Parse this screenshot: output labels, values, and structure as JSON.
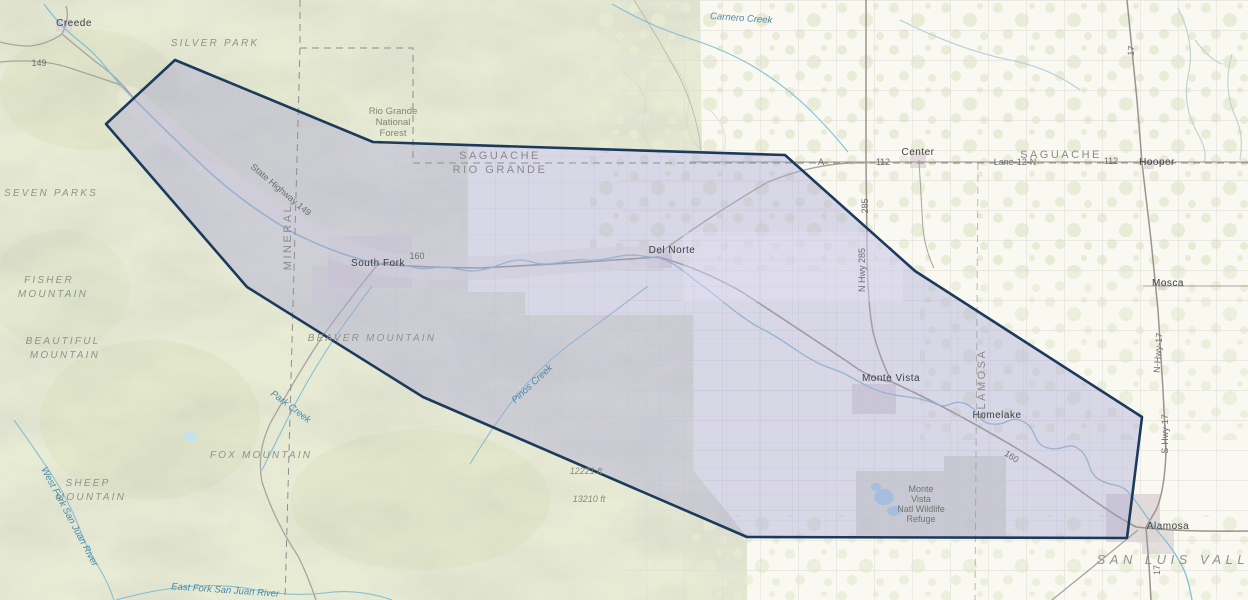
{
  "map": {
    "labels": [
      {
        "text": "Creede",
        "x": 74,
        "y": 26,
        "rot": 0,
        "cls": "town"
      },
      {
        "text": "South Fork",
        "x": 378,
        "y": 266,
        "rot": 0,
        "cls": "town"
      },
      {
        "text": "Del Norte",
        "x": 672,
        "y": 253,
        "rot": 0,
        "cls": "town"
      },
      {
        "text": "Monte Vista",
        "x": 891,
        "y": 381,
        "rot": 0,
        "cls": "town"
      },
      {
        "text": "Center",
        "x": 918,
        "y": 155,
        "rot": 0,
        "cls": "town"
      },
      {
        "text": "Hooper",
        "x": 1157,
        "y": 165,
        "rot": 0,
        "cls": "town"
      },
      {
        "text": "Mosca",
        "x": 1168,
        "y": 286,
        "rot": 0,
        "cls": "town"
      },
      {
        "text": "Homelake",
        "x": 997,
        "y": 418,
        "rot": 0,
        "cls": "town"
      },
      {
        "text": "Alamosa",
        "x": 1168,
        "y": 529,
        "rot": 0,
        "cls": "town"
      },
      {
        "text": "SAGUACHE",
        "x": 500,
        "y": 159,
        "rot": 0,
        "cls": "county"
      },
      {
        "text": "RIO GRANDE",
        "x": 500,
        "y": 173,
        "rot": 0,
        "cls": "county"
      },
      {
        "text": "SAGUACHE",
        "x": 1061,
        "y": 158,
        "rot": 0,
        "cls": "county"
      },
      {
        "text": "MINERAL",
        "x": 291,
        "y": 237,
        "rot": -90,
        "cls": "county"
      },
      {
        "text": "ALAMOSA",
        "x": 985,
        "y": 384,
        "rot": -90,
        "cls": "county"
      },
      {
        "text": "SILVER PARK",
        "x": 215,
        "y": 46,
        "rot": 0,
        "cls": "park"
      },
      {
        "text": "SEVEN PARKS",
        "x": 51,
        "y": 196,
        "rot": 0,
        "cls": "park"
      },
      {
        "text": "FISHER",
        "x": 49,
        "y": 283,
        "rot": 0,
        "cls": "park"
      },
      {
        "text": "MOUNTAIN",
        "x": 53,
        "y": 297,
        "rot": 0,
        "cls": "park"
      },
      {
        "text": "BEAUTIFUL",
        "x": 63,
        "y": 344,
        "rot": 0,
        "cls": "park"
      },
      {
        "text": "MOUNTAIN",
        "x": 65,
        "y": 358,
        "rot": 0,
        "cls": "park"
      },
      {
        "text": "SHEEP",
        "x": 88,
        "y": 486,
        "rot": 0,
        "cls": "park"
      },
      {
        "text": "MOUNTAIN",
        "x": 91,
        "y": 500,
        "rot": 0,
        "cls": "park"
      },
      {
        "text": "FOX MOUNTAIN",
        "x": 261,
        "y": 458,
        "rot": 0,
        "cls": "park"
      },
      {
        "text": "BEAVER MOUNTAIN",
        "x": 372,
        "y": 341,
        "rot": 0,
        "cls": "park"
      },
      {
        "text": "SAN LUIS VALLEY",
        "x": 1186,
        "y": 564,
        "rot": 0,
        "cls": "park-lg"
      },
      {
        "text": "Rio Grande",
        "x": 393,
        "y": 114,
        "rot": 0,
        "cls": "forest"
      },
      {
        "text": "National",
        "x": 393,
        "y": 125,
        "rot": 0,
        "cls": "forest"
      },
      {
        "text": "Forest",
        "x": 393,
        "y": 136,
        "rot": 0,
        "cls": "forest"
      },
      {
        "text": "Monte",
        "x": 921,
        "y": 492,
        "rot": 0,
        "cls": "refuge"
      },
      {
        "text": "Vista",
        "x": 921,
        "y": 502,
        "rot": 0,
        "cls": "refuge"
      },
      {
        "text": "Natl Wildlife",
        "x": 921,
        "y": 512,
        "rot": 0,
        "cls": "refuge"
      },
      {
        "text": "Refuge",
        "x": 921,
        "y": 522,
        "rot": 0,
        "cls": "refuge"
      },
      {
        "text": "Carnero Creek",
        "x": 741,
        "y": 21,
        "rot": 4,
        "cls": "water"
      },
      {
        "text": "Park Creek",
        "x": 289,
        "y": 409,
        "rot": 37,
        "cls": "water"
      },
      {
        "text": "Pinos Creek",
        "x": 534,
        "y": 386,
        "rot": -43,
        "cls": "water"
      },
      {
        "text": "West Fork San Juan River",
        "x": 67,
        "y": 518,
        "rot": 62,
        "cls": "water"
      },
      {
        "text": "East Fork San Juan River",
        "x": 225,
        "y": 593,
        "rot": 4,
        "cls": "water"
      },
      {
        "text": "State Highway 149",
        "x": 279,
        "y": 192,
        "rot": 40,
        "cls": "road"
      },
      {
        "text": "149",
        "x": 39,
        "y": 66,
        "rot": 0,
        "cls": "road"
      },
      {
        "text": "160",
        "x": 417,
        "y": 259,
        "rot": 0,
        "cls": "road"
      },
      {
        "text": "160",
        "x": 1010,
        "y": 459,
        "rot": 33,
        "cls": "road"
      },
      {
        "text": "A",
        "x": 821,
        "y": 165,
        "rot": 0,
        "cls": "road"
      },
      {
        "text": "112",
        "x": 883,
        "y": 165,
        "rot": 0,
        "cls": "road"
      },
      {
        "text": "112",
        "x": 1111,
        "y": 164,
        "rot": 0,
        "cls": "road"
      },
      {
        "text": "Lane-12-N",
        "x": 1015,
        "y": 165,
        "rot": 0,
        "cls": "road"
      },
      {
        "text": "285",
        "x": 868,
        "y": 206,
        "rot": -90,
        "cls": "road"
      },
      {
        "text": "N Hwy 285",
        "x": 865,
        "y": 270,
        "rot": -90,
        "cls": "road"
      },
      {
        "text": "17",
        "x": 1134,
        "y": 51,
        "rot": -85,
        "cls": "road"
      },
      {
        "text": "N-Hwy-17",
        "x": 1161,
        "y": 353,
        "rot": -86,
        "cls": "road"
      },
      {
        "text": "S-Hwy-17",
        "x": 1168,
        "y": 434,
        "rot": -90,
        "cls": "road"
      },
      {
        "text": "17",
        "x": 1160,
        "y": 570,
        "rot": -90,
        "cls": "road"
      },
      {
        "text": "12221 ft",
        "x": 586,
        "y": 474,
        "rot": 0,
        "cls": "elev"
      },
      {
        "text": "13210 ft",
        "x": 589,
        "y": 502,
        "rot": 0,
        "cls": "elev"
      }
    ]
  },
  "selection": {
    "points_str": "175,60 373,142 785,155 915,271 1142,417 1127,538 747,537 423,397 247,287 106,124",
    "outline_color": "#1b3a5c",
    "fill_color": "#a8a6d4"
  },
  "colors": {
    "valley": "#f9f8f1",
    "terrain_green": "#e8ecd5",
    "water_blue": "#86bfd4",
    "road_gray": "#9a958e",
    "county_dash": "#8f8f8f"
  }
}
